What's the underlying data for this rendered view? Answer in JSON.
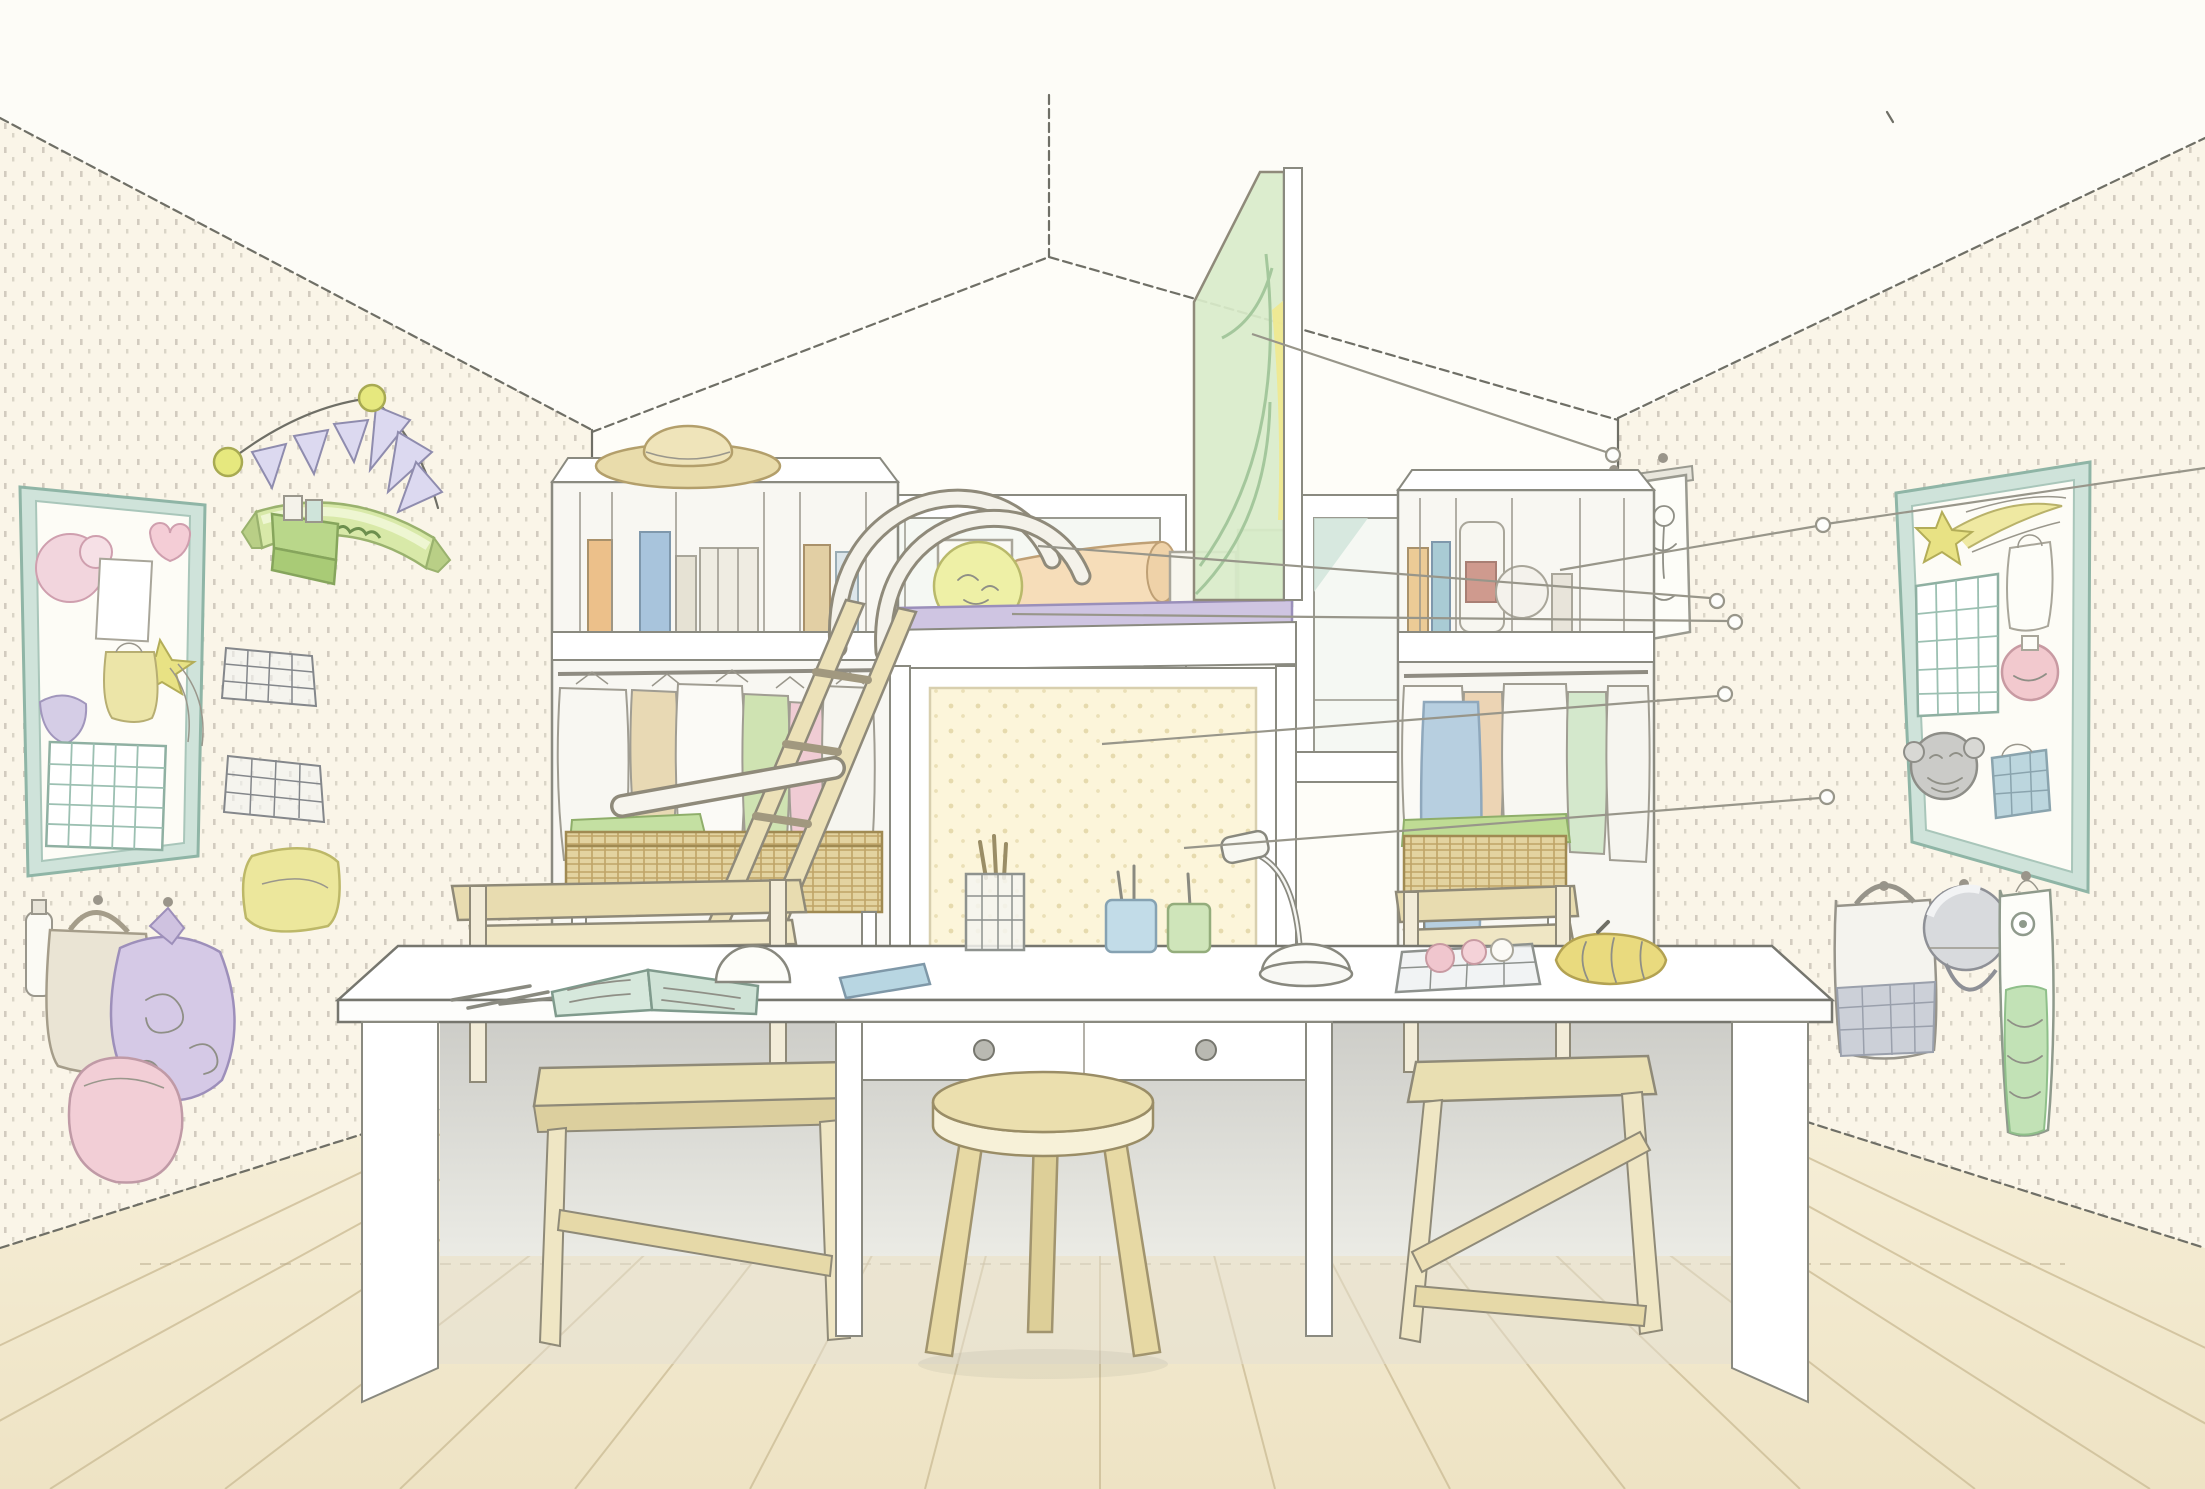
{
  "illustration": {
    "medium": "pencil and watercolor interior rendering",
    "subject": "children's shared study room: loft bed over a pinboard, long white desk with stool and two wooden chairs, open closets, pegboard side walls with hanging bags and bulletin boards",
    "perspective": "wide-angle room view with gabled ceiling"
  },
  "palette": {
    "background": "#fdfcf7",
    "wall_cream": "#faf5e8",
    "back_wall": "#fefdf8",
    "floor": "#f2e9d2",
    "plank_line": "#cfc09a",
    "ink": "#6f6f66",
    "wood_light": "#e9dfb2",
    "wicker": "#e3d3a0",
    "teal_frame": "#bedcd2",
    "glass_green": "#d9ecca",
    "ribbon_green": "#d8e9a8",
    "pennant_purple": "#dcd9f0",
    "ball_yellow": "#eef0a6",
    "bolster_peach": "#f6ddb9",
    "mattress_purple": "#cfc5e2",
    "pouch_lavender": "#d5c9e6",
    "pouch_pink": "#f2ced6",
    "notebook_blue": "#b8d6e2",
    "leader_gray": "#98968a"
  },
  "counts": {
    "windows": 2,
    "desk_bays": 3,
    "desk_drawers": 2,
    "pennant_flags": 6,
    "leader_callout_lines": 6,
    "bulletin_boards": 2,
    "closets": 2,
    "chairs": 2,
    "stools": 1
  },
  "objects": {
    "room": {
      "label": "children's study room illustration"
    },
    "ceiling": {
      "label": "gabled ceiling with ridge lines"
    },
    "left_wall": {
      "label": "left pegboard wall, cream with stippled holes"
    },
    "right_wall": {
      "label": "right pegboard wall, cream with stippled holes"
    },
    "back_wall": {
      "label": "back wall with windows"
    },
    "floor": {
      "label": "light wood plank floor"
    },
    "window_left": {
      "label": "left window with white frame"
    },
    "window_right": {
      "label": "right window with white frame"
    },
    "garland": {
      "label": "purple pennant garland with yellow balls"
    },
    "ribbon": {
      "label": "green ribbon banner with hand-written scribble"
    },
    "board_left": {
      "label": "left bulletin board with pinned papers, flower, star, bag sketch and calendar grid"
    },
    "green_shelf": {
      "label": "small green wall shelf"
    },
    "wire_baskets": {
      "label": "two wire wall baskets"
    },
    "yellow_cushion": {
      "label": "yellow cloth on wall hook"
    },
    "bags_left": {
      "label": "hanging bags: bottle, tan tote, lavender pouch, pink pouch"
    },
    "scrolls": {
      "label": "two small hanging scrolls near right corner"
    },
    "board_right": {
      "label": "right bulletin board with shooting star, calendar, apron, pomander, monkey mask and plaid pouch"
    },
    "bags_right": {
      "label": "hanging tote, helmet and green carp streamer"
    },
    "closet_left": {
      "label": "open closet: hat, books, hanging clothes, wicker basket"
    },
    "closet_right": {
      "label": "open closet: jars, hanging clothes, jeans, wicker basket with green lid"
    },
    "loft": {
      "label": "loft bed with purple mattress, yellow ball pillow, peach bolster and green cushion"
    },
    "pinboard": {
      "label": "large cream pinboard under the loft"
    },
    "glass_screen": {
      "label": "green-tinted glass screen with curved pattern"
    },
    "ladder": {
      "label": "wooden loft ladder"
    },
    "hooks": {
      "label": "curved white grab handles over the loft edge"
    },
    "grab_bar": {
      "label": "white safety bar"
    },
    "desk": {
      "label": "long white desk with two drawers"
    },
    "drawer_knobs": {
      "label": "round drawer knobs"
    },
    "stool": {
      "label": "round wooden stool"
    },
    "chair_left": {
      "label": "wooden chair at left desk bay"
    },
    "chair_right": {
      "label": "wooden chair at right desk bay"
    },
    "pens": {
      "label": "pencils on desk"
    },
    "open_book": {
      "label": "open picture book"
    },
    "dome": {
      "label": "white rounded desk object"
    },
    "notebook": {
      "label": "blue notebook"
    },
    "pencil_cup": {
      "label": "wire pencil cup"
    },
    "cups": {
      "label": "blue and green pen cups"
    },
    "lamp": {
      "label": "white desk lamp"
    },
    "tray": {
      "label": "wire tray with pink items"
    },
    "yellow_pouch": {
      "label": "yellow pouch"
    },
    "callouts": {
      "label": "six thin annotation leader lines ending in small rings"
    }
  }
}
